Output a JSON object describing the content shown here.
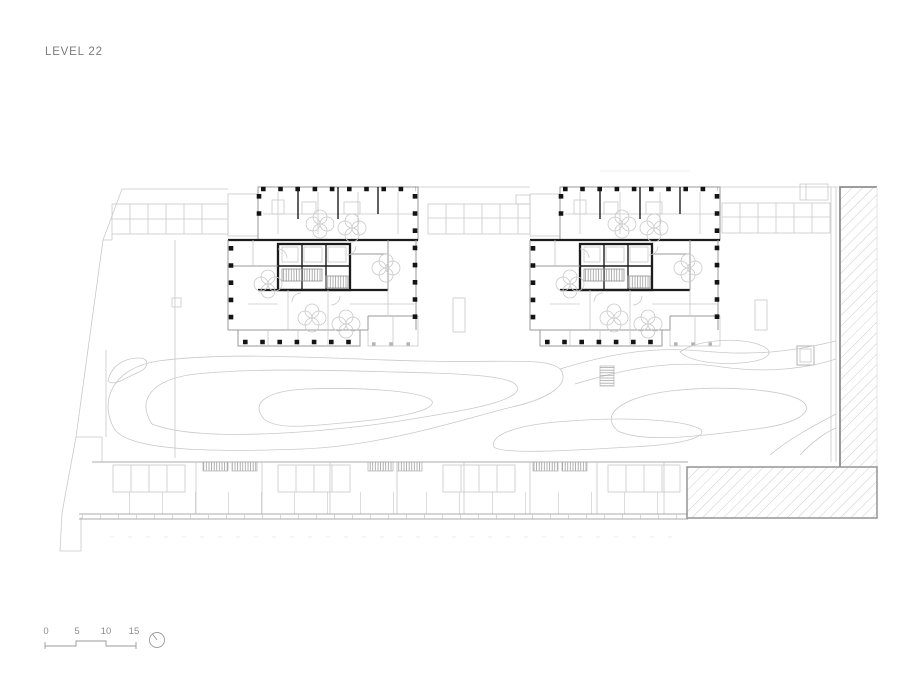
{
  "drawing": {
    "title": "LEVEL 22",
    "type_label": "architectural floor plan"
  },
  "scale_bar": {
    "labels": [
      "0",
      "5",
      "10",
      "15"
    ]
  },
  "compass": {
    "icon": "north-arrow-icon"
  },
  "palette": {
    "background": "#ffffff",
    "wall_dark": "#1c1c1c",
    "wall_medium": "#9a9a9a",
    "line_light": "#c9c9c9",
    "hatch_line": "#c6c6c6",
    "hatch_border": "#9b9b9b",
    "text": "#7c7c7c"
  }
}
